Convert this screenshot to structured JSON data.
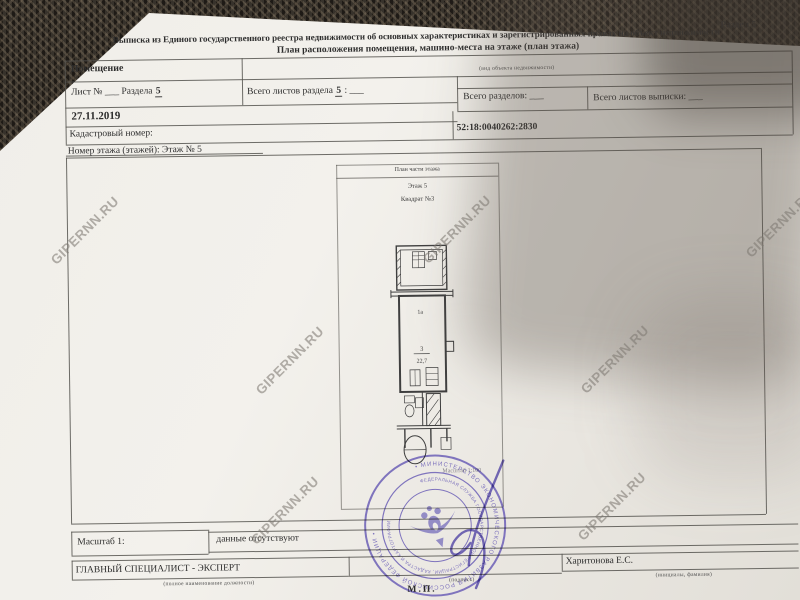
{
  "photo": {
    "watermark_text": "GIPERNN.RU"
  },
  "header": {
    "section": "Раздел 5",
    "title_line1": "Выписка из Единого государственного реестра недвижимости об основных характеристиках и зарегистрированных правах на объект недвижимости",
    "title_line2": "План расположения помещения, машино-места на этаже (план этажа)"
  },
  "object_row": {
    "value": "Помещение",
    "caption": "(вид объекта недвижимости)"
  },
  "sheet_row": {
    "cell1_label": "Лист №",
    "cell1_blank": "___",
    "cell1_mid": "Раздела",
    "cell1_num": "5",
    "cell2_label": "Всего листов раздела",
    "cell2_num": "5",
    "cell2_tail": ": ___",
    "cell3": "Всего разделов: ___",
    "cell4": "Всего листов выписки: ___"
  },
  "date_row": {
    "date": "27.11.2019"
  },
  "cadastral_row": {
    "label": "Кадастровый номер:",
    "value": "52:18:0040262:2830"
  },
  "floor_row": {
    "text": "Номер этажа (этажей): Этаж № 5"
  },
  "plan": {
    "title": "План части этажа",
    "floor_label": "Этаж 5",
    "block_label": "Квадрат №3",
    "room_top_label": "1а",
    "room_number": "3",
    "room_area": "22,7",
    "corner_note": "Масштаб 1:100"
  },
  "scale_row": {
    "label": "Масштаб 1:",
    "value": "данные отсутствуют"
  },
  "footer": {
    "position": "ГЛАВНЫЙ СПЕЦИАЛИСТ - ЭКСПЕРТ",
    "position_caption": "(полное наименование должности)",
    "sign_caption": "(подпись)",
    "name": "Харитонова Е.С.",
    "name_caption": "(инициалы, фамилия)",
    "stamp_mark": "М.П."
  },
  "stamp": {
    "outer_ring_text": "• МИНИСТЕРСТВО ЭКОНОМИЧЕСКОГО РАЗВИТИЯ РОССИЙСКОЙ ФЕДЕРАЦИИ •",
    "inner_ring_text": "ФЕДЕРАЛЬНАЯ СЛУЖБА ГОСУДАРСТВЕННОЙ РЕГИСТРАЦИИ, КАДАСТРА И КАРТОГРАФИИ",
    "color": "#6f63b8"
  }
}
